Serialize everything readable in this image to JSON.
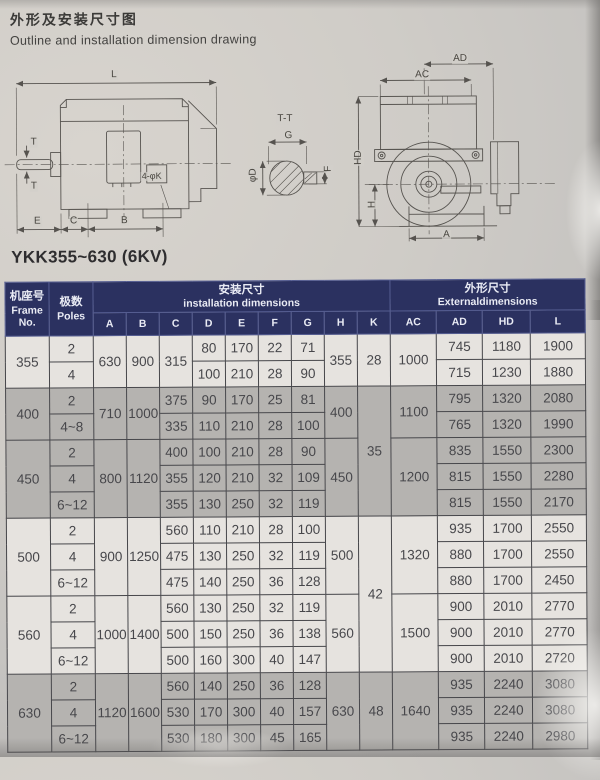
{
  "page": {
    "title_zh": "外形及安装尺寸图",
    "title_en": "Outline and installation dimension drawing",
    "table_title": "YKK355~630 (6KV)"
  },
  "drawings": {
    "side": {
      "L": "L",
      "T_top": "T",
      "T_bottom": "T",
      "E": "E",
      "C": "C",
      "B": "B",
      "holes": "4-φK"
    },
    "section": {
      "title": "T-T",
      "G": "G",
      "F": "F",
      "D": "φD"
    },
    "end": {
      "AD": "AD",
      "AC": "AC",
      "HD": "HD",
      "H": "H",
      "A": "A"
    }
  },
  "colors": {
    "header_bg": "#2b3160",
    "row_light": "#e6e3df",
    "row_gray": "#b5b3b0"
  },
  "table": {
    "header": {
      "frame_zh": "机座号",
      "frame_en1": "Frame",
      "frame_en2": "No.",
      "poles_zh": "极数",
      "poles_en": "Poles",
      "install_zh": "安装尺寸",
      "install_en": "installation dimensions",
      "external_zh": "外形尺寸",
      "external_en": "Externaldimensions",
      "install_cols": [
        "A",
        "B",
        "C",
        "D",
        "E",
        "F",
        "G",
        "H",
        "K"
      ],
      "external_cols": [
        "AC",
        "AD",
        "HD",
        "L"
      ]
    },
    "groups": [
      {
        "frame": "355",
        "shade": "light",
        "A": "630",
        "B": "900",
        "C_merged": "315",
        "H": "355",
        "K": "28",
        "K_span": 2,
        "AC": "1000",
        "rows": [
          {
            "poles": "2",
            "D": "80",
            "E": "170",
            "F": "22",
            "G": "71",
            "AD": "745",
            "HD": "1180",
            "L": "1900"
          },
          {
            "poles": "4",
            "D": "100",
            "E": "210",
            "F": "28",
            "G": "90",
            "AD": "715",
            "HD": "1230",
            "L": "1880"
          }
        ]
      },
      {
        "frame": "400",
        "shade": "gray",
        "A": "710",
        "B": "1000",
        "H": "400",
        "K": "35",
        "K_span": 5,
        "AC": "1100",
        "rows": [
          {
            "poles": "2",
            "C": "375",
            "D": "90",
            "E": "170",
            "F": "25",
            "G": "81",
            "AD": "795",
            "HD": "1320",
            "L": "2080"
          },
          {
            "poles": "4~8",
            "C": "335",
            "D": "110",
            "E": "210",
            "F": "28",
            "G": "100",
            "AD": "765",
            "HD": "1320",
            "L": "1990"
          }
        ]
      },
      {
        "frame": "450",
        "shade": "gray",
        "A": "800",
        "B": "1120",
        "H": "450",
        "AC": "1200",
        "rows": [
          {
            "poles": "2",
            "C": "400",
            "D": "100",
            "E": "210",
            "F": "28",
            "G": "90",
            "AD": "835",
            "HD": "1550",
            "L": "2300"
          },
          {
            "poles": "4",
            "C": "355",
            "D": "120",
            "E": "210",
            "F": "32",
            "G": "109",
            "AD": "815",
            "HD": "1550",
            "L": "2280"
          },
          {
            "poles": "6~12",
            "C": "355",
            "D": "130",
            "E": "250",
            "F": "32",
            "G": "119",
            "AD": "815",
            "HD": "1550",
            "L": "2170"
          }
        ]
      },
      {
        "frame": "500",
        "shade": "light",
        "A": "900",
        "B": "1250",
        "H": "500",
        "K": "42",
        "K_span": 6,
        "AC": "1320",
        "rows": [
          {
            "poles": "2",
            "C": "560",
            "D": "110",
            "E": "210",
            "F": "28",
            "G": "100",
            "AD": "935",
            "HD": "1700",
            "L": "2550"
          },
          {
            "poles": "4",
            "C": "475",
            "D": "130",
            "E": "250",
            "F": "32",
            "G": "119",
            "AD": "880",
            "HD": "1700",
            "L": "2550"
          },
          {
            "poles": "6~12",
            "C": "475",
            "D": "140",
            "E": "250",
            "F": "36",
            "G": "128",
            "AD": "880",
            "HD": "1700",
            "L": "2450"
          }
        ]
      },
      {
        "frame": "560",
        "shade": "light",
        "A": "1000",
        "B": "1400",
        "H": "560",
        "AC": "1500",
        "rows": [
          {
            "poles": "2",
            "C": "560",
            "D": "130",
            "E": "250",
            "F": "32",
            "G": "119",
            "AD": "900",
            "HD": "2010",
            "L": "2770"
          },
          {
            "poles": "4",
            "C": "500",
            "D": "150",
            "E": "250",
            "F": "36",
            "G": "138",
            "AD": "900",
            "HD": "2010",
            "L": "2770"
          },
          {
            "poles": "6~12",
            "C": "500",
            "D": "160",
            "E": "300",
            "F": "40",
            "G": "147",
            "AD": "900",
            "HD": "2010",
            "L": "2720"
          }
        ]
      },
      {
        "frame": "630",
        "shade": "gray",
        "A": "1120",
        "B": "1600",
        "H": "630",
        "K": "48",
        "K_span": 3,
        "AC": "1640",
        "rows": [
          {
            "poles": "2",
            "C": "560",
            "D": "140",
            "E": "250",
            "F": "36",
            "G": "128",
            "AD": "935",
            "HD": "2240",
            "L": "3080"
          },
          {
            "poles": "4",
            "C": "530",
            "D": "170",
            "E": "300",
            "F": "40",
            "G": "157",
            "AD": "935",
            "HD": "2240",
            "L": "3080"
          },
          {
            "poles": "6~12",
            "C": "530",
            "D": "180",
            "E": "300",
            "F": "45",
            "G": "165",
            "AD": "935",
            "HD": "2240",
            "L": "2980"
          }
        ]
      }
    ]
  }
}
